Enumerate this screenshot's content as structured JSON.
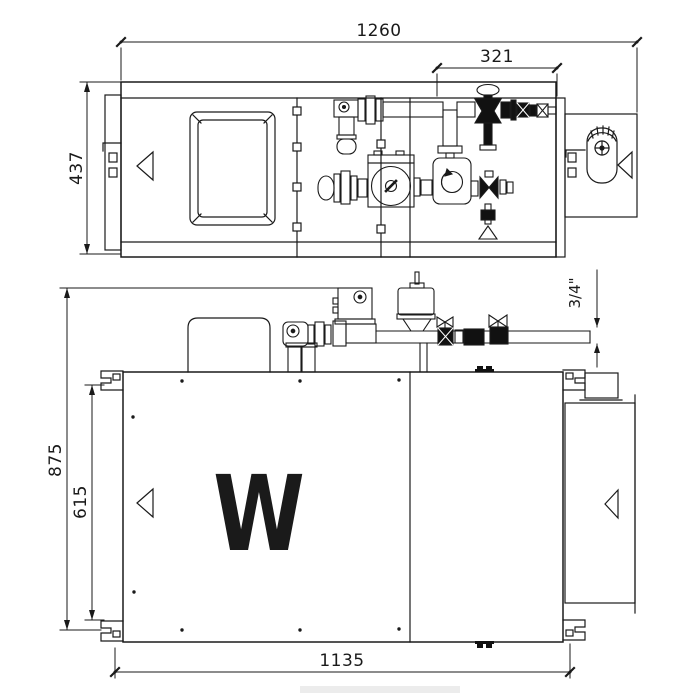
{
  "drawing_title": "ventilation-unit-two-view-technical-drawing",
  "colors": {
    "background": "#ffffff",
    "line": "#1a1a1a",
    "fill_dark": "#111111"
  },
  "dims": {
    "overall_width": "1260",
    "piping_width": "321",
    "depth": "437",
    "overall_height": "875",
    "cabinet_height": "615",
    "cabinet_width": "1135",
    "pipe_size": "3/4\""
  },
  "branding": {
    "logo": "W"
  },
  "icons": {
    "airflow_direction": "left-pointing-triangle-outline",
    "pump": "circle-with-slot-screw",
    "mixing_valve": "rounded-square-with-rotary-dial",
    "shutoff_valve": "filled-globe-valve-with-oval-handle",
    "ball_valve": "bowtie-handle-valve",
    "air_separator": "cylinder-with-cone-bottom",
    "actuator": "square-box-with-indicator-circle",
    "drain_valve": "stem-with-funnel-triangle",
    "mounting_clip": "notched-bracket"
  }
}
